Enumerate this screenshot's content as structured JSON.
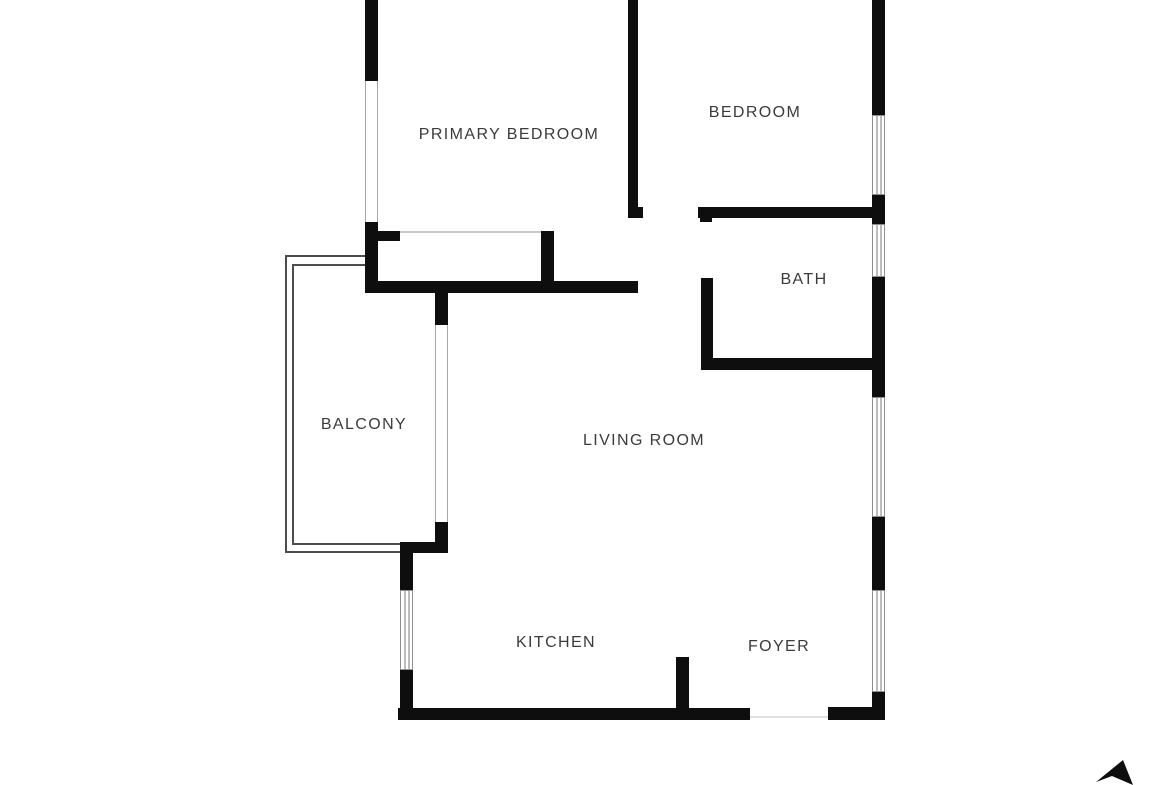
{
  "title": "Apartment floor plan",
  "colors": {
    "wall": "#0e0e0e",
    "background": "#ffffff",
    "label_text": "#3b3b3b",
    "railing": "#4d4d4d",
    "window_outline": "#8f8f8f",
    "window_inner": "#7a7a7a",
    "glass_line": "#a8a8a8"
  },
  "rooms": [
    {
      "id": "primary-bedroom",
      "label": "PRIMARY BEDROOM",
      "x": 509,
      "y": 135
    },
    {
      "id": "bedroom",
      "label": "BEDROOM",
      "x": 755,
      "y": 113
    },
    {
      "id": "bath",
      "label": "BATH",
      "x": 804,
      "y": 280
    },
    {
      "id": "balcony",
      "label": "BALCONY",
      "x": 364,
      "y": 425
    },
    {
      "id": "living-room",
      "label": "LIVING ROOM",
      "x": 644,
      "y": 441
    },
    {
      "id": "kitchen",
      "label": "KITCHEN",
      "x": 556,
      "y": 643
    },
    {
      "id": "foyer",
      "label": "FOYER",
      "x": 779,
      "y": 647
    }
  ],
  "floorplan": {
    "walls": [
      {
        "name": "left-wall-top",
        "x": 365,
        "y": 0,
        "w": 13,
        "h": 81
      },
      {
        "name": "left-wall-lower",
        "x": 365,
        "y": 222,
        "w": 13,
        "h": 71
      },
      {
        "name": "primary-bottom-wall",
        "x": 365,
        "y": 281,
        "w": 273,
        "h": 12
      },
      {
        "name": "closet-stub-left",
        "x": 378,
        "y": 231,
        "w": 22,
        "h": 10
      },
      {
        "name": "closet-stub-right",
        "x": 541,
        "y": 231,
        "w": 13,
        "h": 60
      },
      {
        "name": "bedroom-divider-wall",
        "x": 628,
        "y": 0,
        "w": 10,
        "h": 218
      },
      {
        "name": "bedroom-door-nub",
        "x": 638,
        "y": 207,
        "w": 5,
        "h": 11
      },
      {
        "name": "bedroom-bottom-wall",
        "x": 698,
        "y": 207,
        "w": 174,
        "h": 11
      },
      {
        "name": "bath-left-wall-upper",
        "x": 700,
        "y": 207,
        "w": 12,
        "h": 15
      },
      {
        "name": "bath-left-wall-lower",
        "x": 701,
        "y": 278,
        "w": 12,
        "h": 80
      },
      {
        "name": "bath-bottom-wall",
        "x": 701,
        "y": 358,
        "w": 171,
        "h": 12
      },
      {
        "name": "right-wall-1",
        "x": 872,
        "y": 0,
        "w": 13,
        "h": 115
      },
      {
        "name": "right-wall-2",
        "x": 872,
        "y": 195,
        "w": 13,
        "h": 29
      },
      {
        "name": "right-wall-3",
        "x": 872,
        "y": 277,
        "w": 13,
        "h": 120
      },
      {
        "name": "right-wall-4",
        "x": 872,
        "y": 517,
        "w": 13,
        "h": 73
      },
      {
        "name": "right-wall-5",
        "x": 872,
        "y": 692,
        "w": 13,
        "h": 28
      },
      {
        "name": "balcony-stub-top",
        "x": 435,
        "y": 293,
        "w": 13,
        "h": 32
      },
      {
        "name": "balcony-stub-bottom",
        "x": 435,
        "y": 522,
        "w": 13,
        "h": 31
      },
      {
        "name": "kitchen-top-wall",
        "x": 400,
        "y": 542,
        "w": 48,
        "h": 11
      },
      {
        "name": "kitchen-left-upper",
        "x": 400,
        "y": 553,
        "w": 13,
        "h": 37
      },
      {
        "name": "kitchen-left-lower",
        "x": 400,
        "y": 670,
        "w": 13,
        "h": 50
      },
      {
        "name": "bottom-wall-left",
        "x": 398,
        "y": 708,
        "w": 352,
        "h": 12
      },
      {
        "name": "bottom-wall-right",
        "x": 828,
        "y": 707,
        "w": 57,
        "h": 13
      },
      {
        "name": "bottom-right-corner",
        "x": 872,
        "y": 697,
        "w": 13,
        "h": 23
      },
      {
        "name": "kitchen-foyer-stub",
        "x": 676,
        "y": 657,
        "w": 13,
        "h": 63
      }
    ],
    "windows": [
      {
        "name": "bedroom-window",
        "x": 872,
        "y": 115,
        "w": 13,
        "h": 80
      },
      {
        "name": "bath-window",
        "x": 872,
        "y": 224,
        "w": 13,
        "h": 53
      },
      {
        "name": "living-room-window",
        "x": 872,
        "y": 397,
        "w": 13,
        "h": 120
      },
      {
        "name": "foyer-window",
        "x": 872,
        "y": 590,
        "w": 13,
        "h": 102
      },
      {
        "name": "kitchen-window",
        "x": 400,
        "y": 590,
        "w": 13,
        "h": 80
      }
    ],
    "glass_panels": [
      {
        "name": "primary-bedroom-glass-wall",
        "x": 365,
        "y": 81,
        "w": 13,
        "h": 141
      },
      {
        "name": "balcony-slider-glass",
        "x": 435,
        "y": 325,
        "w": 13,
        "h": 197
      }
    ],
    "railing": [
      {
        "name": "balcony-rail-outer-left",
        "x": 285,
        "y": 255,
        "w": 2,
        "h": 298
      },
      {
        "name": "balcony-rail-outer-top",
        "x": 285,
        "y": 255,
        "w": 80,
        "h": 2
      },
      {
        "name": "balcony-rail-outer-bottom",
        "x": 285,
        "y": 551,
        "w": 115,
        "h": 2
      },
      {
        "name": "balcony-rail-inner-left",
        "x": 292,
        "y": 264,
        "w": 2,
        "h": 281
      },
      {
        "name": "balcony-rail-inner-top",
        "x": 292,
        "y": 264,
        "w": 73,
        "h": 2
      },
      {
        "name": "balcony-rail-inner-bottom",
        "x": 292,
        "y": 543,
        "w": 108,
        "h": 2
      }
    ],
    "thin_lines": [
      {
        "name": "closet-door-track",
        "x": 400,
        "y": 231,
        "w": 141,
        "h": 2,
        "color": "#c8c8c8"
      },
      {
        "name": "entry-threshold",
        "x": 750,
        "y": 716,
        "w": 78,
        "h": 2,
        "color": "#e2e2e2"
      }
    ]
  },
  "compass": {
    "name": "north-arrow"
  }
}
